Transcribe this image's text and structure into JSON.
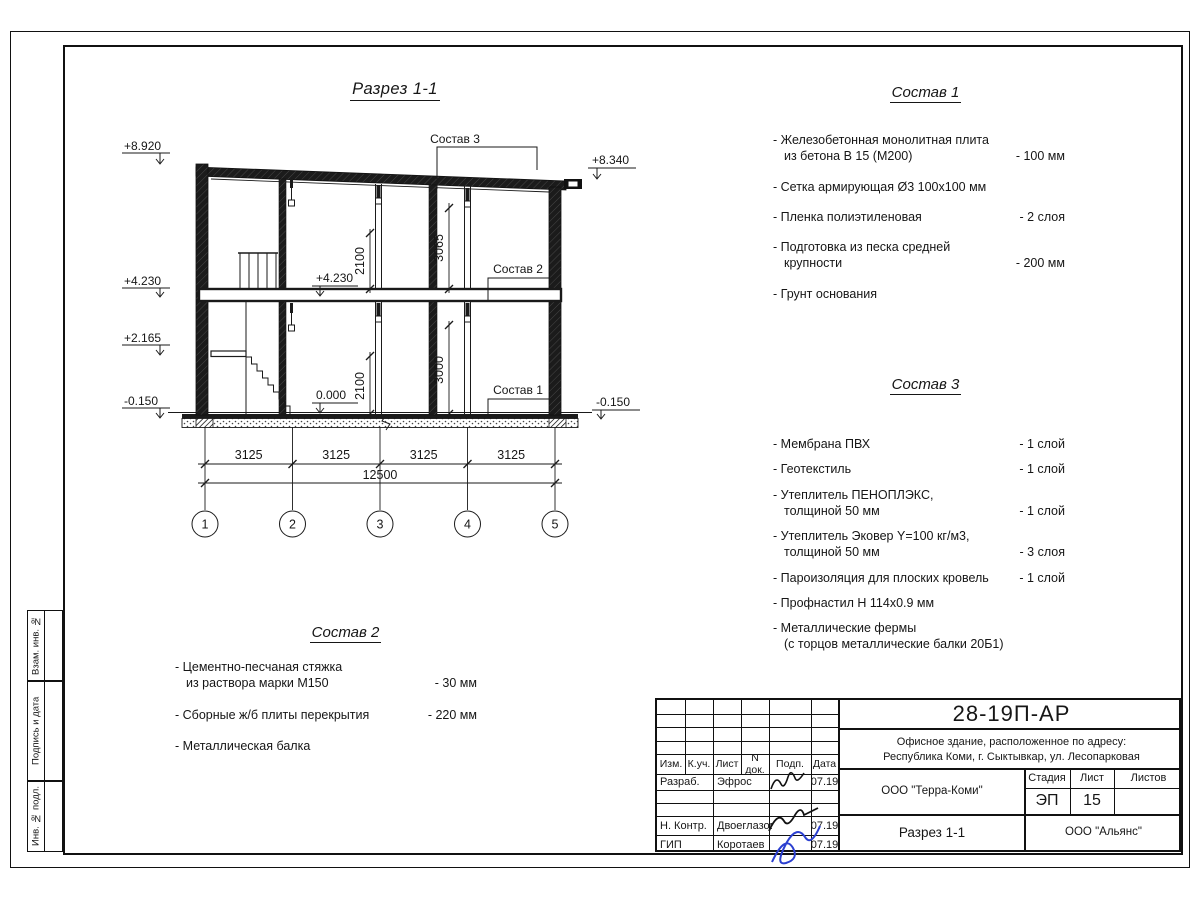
{
  "drawing": {
    "title": "Разрез 1-1",
    "axes": [
      "1",
      "2",
      "3",
      "4",
      "5"
    ],
    "dims": {
      "bays": [
        "3125",
        "3125",
        "3125",
        "3125"
      ],
      "total": "12500",
      "v_upper_door": "2100",
      "v_upper_room": "3065",
      "v_lower_door": "2100",
      "v_lower_room": "3000"
    },
    "levels": {
      "left": [
        "+8.920",
        "+4.230",
        "+2.165",
        "-0.150"
      ],
      "right_top": "+8.340",
      "right_bottom": "-0.150",
      "inner_upper": "+4.230",
      "inner_lower": "0.000"
    },
    "callouts": {
      "c3": "Состав 3",
      "c2": "Состав 2",
      "c1": "Состав 1"
    }
  },
  "lists": {
    "sostav1": {
      "title": "Состав 1",
      "items": [
        {
          "label": "- Железобетонная  монолитная плита\nиз бетона В 15 (М200)",
          "value": "- 100 мм"
        },
        {
          "label": "- Сетка армирующая Ø3 100х100 мм",
          "value": ""
        },
        {
          "label": "- Пленка полиэтиленовая",
          "value": "-  2 слоя"
        },
        {
          "label": "- Подготовка из песка средней\nкрупности",
          "value": "- 200 мм"
        },
        {
          "label": "- Грунт основания",
          "value": ""
        }
      ]
    },
    "sostav2": {
      "title": "Состав 2",
      "items": [
        {
          "label": "- Цементно-песчаная стяжка\nиз раствора марки М150",
          "value": "- 30 мм"
        },
        {
          "label": "- Сборные ж/б плиты перекрытия",
          "value": "- 220 мм"
        },
        {
          "label": "- Металлическая балка",
          "value": ""
        }
      ]
    },
    "sostav3": {
      "title": "Состав 3",
      "items": [
        {
          "label": "- Мембрана ПВХ",
          "value": "- 1 слой"
        },
        {
          "label": "- Геотекстиль",
          "value": "- 1 слой"
        },
        {
          "label": "- Утеплитель ПЕНОПЛЭКС,\nтолщиной 50 мм",
          "value": "- 1 слой"
        },
        {
          "label": "- Утеплитель Эковер Y=100 кг/м3,\nтолщиной 50 мм",
          "value": "- 3 слоя"
        },
        {
          "label": "- Пароизоляция для плоских кровель",
          "value": "- 1 слой"
        },
        {
          "label": "- Профнастил Н 114х0.9 мм",
          "value": ""
        },
        {
          "label": "- Металлические фермы\n(с торцов металлические балки 20Б1)",
          "value": ""
        }
      ]
    }
  },
  "titleblock": {
    "doc_number": "28-19П-АР",
    "address_line1": "Офисное здание, расположенное по адресу:",
    "address_line2": "Республика Коми, г. Сыктывкар, ул. Лесопарковая",
    "org": "ООО \"Терра-Коми\"",
    "sheet_title": "Разрез 1-1",
    "contractor": "ООО \"Альянс\"",
    "headers": {
      "izm": "Изм.",
      "kuch": "К.уч.",
      "list": "Лист",
      "ndok": "N док.",
      "podp": "Подп.",
      "data": "Дата",
      "stage": "Стадия",
      "sheet": "Лист",
      "sheets": "Листов"
    },
    "stage_value": "ЭП",
    "sheet_value": "15",
    "sheets_value": "",
    "rows": [
      {
        "role": "Разраб.",
        "name": "Эфрос",
        "date": "07.19"
      },
      {
        "role": "",
        "name": "",
        "date": ""
      },
      {
        "role": "",
        "name": "",
        "date": ""
      },
      {
        "role": "Н. Контр.",
        "name": "Двоеглазов",
        "date": "07.19"
      },
      {
        "role": "ГИП",
        "name": "Коротаев",
        "date": "07.19"
      }
    ]
  },
  "side_stamps": [
    "Взам. инв. №",
    "Подпись и дата",
    "Инв. № подл."
  ]
}
